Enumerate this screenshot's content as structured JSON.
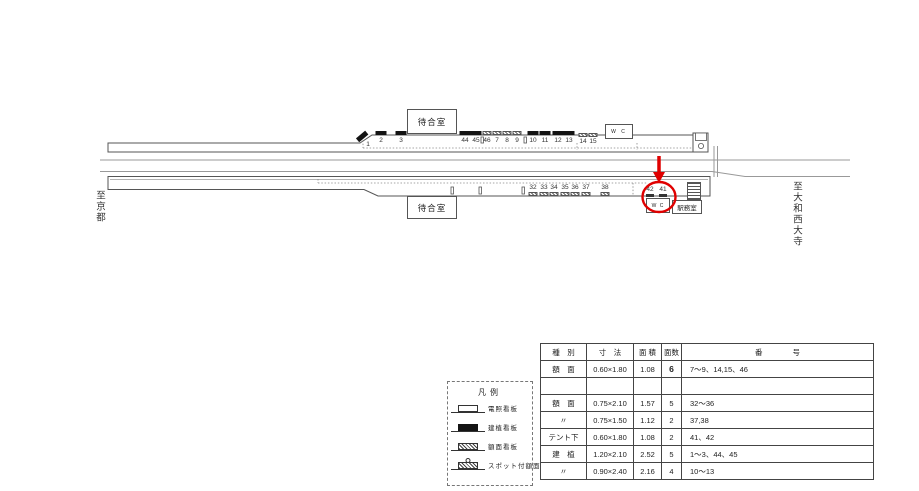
{
  "diagram": {
    "left_label": "至京都",
    "right_label": "至大和西大寺",
    "waiting_room_top": "待合室",
    "waiting_room_bottom": "待合室",
    "wc_top": "W C",
    "wc_bottom": "W C",
    "station_office": "駅務室",
    "annotation_color": "#e00000",
    "signs": [
      {
        "num": "1",
        "x": 368,
        "numY": 141.5,
        "markY": 134,
        "kind": "slope",
        "rot": -40,
        "markX": 362
      },
      {
        "num": "2",
        "x": 381,
        "numY": 137.5,
        "markY": 130.5,
        "kind": "black"
      },
      {
        "num": "3",
        "x": 401,
        "numY": 137.5,
        "markY": 130.5,
        "kind": "black"
      },
      {
        "num": "44",
        "x": 465,
        "numY": 137.5,
        "markY": 130.5,
        "kind": "black"
      },
      {
        "num": "45",
        "x": 476,
        "numY": 137.5,
        "markY": 130.5,
        "kind": "black"
      },
      {
        "num": "46",
        "x": 487,
        "numY": 137.5,
        "markY": 131,
        "kind": "hatch"
      },
      {
        "num": "7",
        "x": 497,
        "numY": 137.5,
        "markY": 131,
        "kind": "hatch"
      },
      {
        "num": "8",
        "x": 507,
        "numY": 137.5,
        "markY": 131,
        "kind": "hatch"
      },
      {
        "num": "9",
        "x": 517,
        "numY": 137.5,
        "markY": 131,
        "kind": "hatch"
      },
      {
        "num": "10",
        "x": 533,
        "numY": 137.5,
        "markY": 130.5,
        "kind": "black"
      },
      {
        "num": "11",
        "x": 545,
        "numY": 137.5,
        "markY": 130.5,
        "kind": "black"
      },
      {
        "num": "12",
        "x": 558,
        "numY": 137.5,
        "markY": 130.5,
        "kind": "black"
      },
      {
        "num": "13",
        "x": 569,
        "numY": 137.5,
        "markY": 130.5,
        "kind": "black"
      },
      {
        "num": "14",
        "x": 583,
        "numY": 139,
        "markY": 132.5,
        "kind": "hatch"
      },
      {
        "num": "15",
        "x": 593,
        "numY": 139,
        "markY": 132.5,
        "kind": "hatch"
      },
      {
        "num": "32",
        "x": 533,
        "numY": 184.5,
        "markY": 191.5,
        "kind": "hatch"
      },
      {
        "num": "33",
        "x": 544,
        "numY": 184.5,
        "markY": 191.5,
        "kind": "hatch"
      },
      {
        "num": "34",
        "x": 554,
        "numY": 184.5,
        "markY": 191.5,
        "kind": "hatch"
      },
      {
        "num": "35",
        "x": 565,
        "numY": 184.5,
        "markY": 191.5,
        "kind": "hatch"
      },
      {
        "num": "36",
        "x": 575,
        "numY": 184.5,
        "markY": 191.5,
        "kind": "hatch"
      },
      {
        "num": "37",
        "x": 586,
        "numY": 184.5,
        "markY": 191.5,
        "kind": "hatch"
      },
      {
        "num": "38",
        "x": 605,
        "numY": 184.5,
        "markY": 191.5,
        "kind": "hatch"
      },
      {
        "num": "42",
        "x": 650,
        "numY": 186.5,
        "markY": 194,
        "kind": "tent"
      },
      {
        "num": "41",
        "x": 663,
        "numY": 186.5,
        "markY": 194,
        "kind": "tent"
      }
    ]
  },
  "legend": {
    "title": "凡例",
    "items": [
      {
        "kind": "denso",
        "label": "電照看板"
      },
      {
        "kind": "kenchoku",
        "label": "建植看板"
      },
      {
        "kind": "gakumen",
        "label": "額面看板"
      },
      {
        "kind": "spot",
        "label": "スポット付額面"
      }
    ]
  },
  "table": {
    "headers": [
      "種　別",
      "寸　法",
      "面 積",
      "面数",
      "番　　　　号"
    ],
    "col_widths": [
      46,
      47,
      28,
      20,
      192
    ],
    "rows": [
      {
        "cells": [
          "額　面",
          "0.60×1.80",
          "1.08",
          "6",
          "7～9、14,15、46"
        ],
        "emph": true
      },
      {
        "cells": [
          "",
          "",
          "",
          "",
          ""
        ],
        "emph": false
      },
      {
        "cells": [
          "額　面",
          "0.75×2.10",
          "1.57",
          "5",
          "32～36"
        ],
        "emph": false
      },
      {
        "cells": [
          "〃",
          "0.75×1.50",
          "1.12",
          "2",
          "37,38"
        ],
        "emph": false
      },
      {
        "cells": [
          "テント下",
          "0.60×1.80",
          "1.08",
          "2",
          "41、42"
        ],
        "emph": false
      },
      {
        "cells": [
          "建　植",
          "1.20×2.10",
          "2.52",
          "5",
          "1～3、44、45"
        ],
        "emph": false
      },
      {
        "cells": [
          "〃",
          "0.90×2.40",
          "2.16",
          "4",
          "10～13"
        ],
        "emph": false
      }
    ]
  }
}
